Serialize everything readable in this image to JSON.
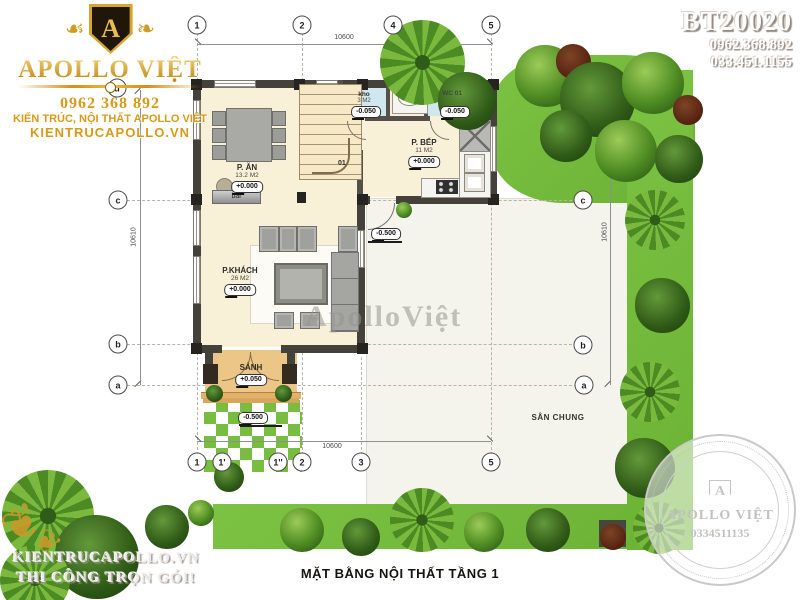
{
  "colors": {
    "gold_accent": "#d89a18",
    "lawn_green": "#76bb3d",
    "floor_cream": "#f8f1d8",
    "wall_dark": "#44403a",
    "wet_room_blue": "#cfe7ef",
    "porch_tan": "#ebc687",
    "watermark_gray": "#b5b3ae"
  },
  "branding": {
    "monogram": "A",
    "brand": "APOLLO VIỆT",
    "phone": "0962 368 892",
    "tagline": "KIẾN TRÚC, NỘI THẤT APOLLO VIỆT",
    "website": "KIENTRUCAPOLLO.VN"
  },
  "project": {
    "code": "BT20020",
    "phone1": "0962.368.892",
    "phone2": "033.451.1155"
  },
  "watermarks": {
    "center": "ApolloViệt",
    "bottom_left_line1": "KIENTRUCAPOLLO.VN",
    "bottom_left_line2": "THI CÔNG TRỌN GÓI!"
  },
  "seal": {
    "monogram": "A",
    "brand": "APOLLO VIỆT",
    "phone": "0334511135"
  },
  "plan": {
    "title": "MẶT BẰNG NỘI THẤT TẦNG 1",
    "rooms": {
      "dining": {
        "name": "P. ĂN",
        "area": "13.2 M2",
        "level": "+0.000"
      },
      "kitchen": {
        "name": "P. BẾP",
        "area": "11 M2",
        "level": "+0.000"
      },
      "living": {
        "name": "P.KHÁCH",
        "area": "26 M2",
        "level": "+0.000"
      },
      "hall": {
        "name": "SẢNH",
        "level": "+0.050"
      },
      "storage": {
        "name": "kho",
        "area": "3 M2",
        "level": "-0.050"
      },
      "wc": {
        "name": "WC 01",
        "level": "-0.050"
      },
      "yard": {
        "name": "SÂN CHUNG"
      },
      "bar": {
        "name": "bar"
      }
    },
    "stair_tag": "01",
    "levels": {
      "path": "-0.500",
      "side_entry": "-0.500"
    },
    "dimensions": {
      "top": "10600",
      "bottom": "10600",
      "left": "10610",
      "right": "10610"
    },
    "grid": {
      "top": [
        "1",
        "2",
        "4",
        "5"
      ],
      "bottom": [
        "1",
        "1'",
        "1''",
        "2",
        "3",
        "5"
      ],
      "left": [
        "d",
        "c",
        "b",
        "a"
      ],
      "right": [
        "c",
        "b",
        "a"
      ]
    }
  }
}
